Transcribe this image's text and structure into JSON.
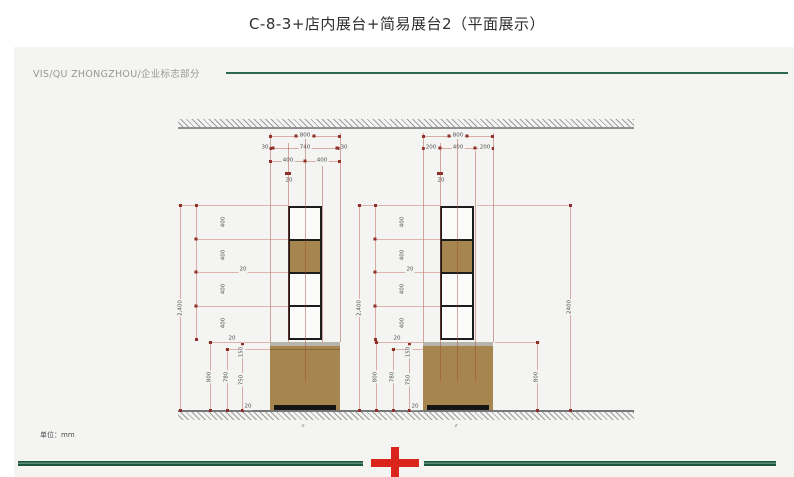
{
  "title": "C-8-3+店内展台+简易展台2（平面展示）",
  "header": {
    "label": "VIS/QU ZHONGZHOU/企业标志部分"
  },
  "footer": {
    "unit_label": "单位：mm"
  },
  "colors": {
    "accent_green": "#2c6a4f",
    "cross_red": "#da251d",
    "wood_brown": "#a6854e",
    "frame_black": "#1c1c1c",
    "dim_tick_red": "#8e2f28",
    "dim_line_pink": "#d9aba5",
    "panel_gray": "#f4f5f3"
  },
  "left_drawing": {
    "marker": "x",
    "top_dims": {
      "total_width": "800",
      "frame_left": "30",
      "inner_width": "740",
      "frame_right": "30",
      "half_left": "400",
      "half_right": "400",
      "board_thickness": "20"
    },
    "side_dims": {
      "overall_height": "2,400",
      "sections": [
        "400",
        "400",
        "400",
        "400"
      ],
      "shelf_thickness_upper": "20",
      "shelf_thickness_lower": "20",
      "counter_height": "800",
      "counter_inner": "780",
      "counter_body": "750",
      "counter_top": "150",
      "plinth": "20"
    }
  },
  "right_drawing": {
    "marker": "z",
    "top_dims": {
      "total_width": "800",
      "side_left": "200",
      "tower_width": "400",
      "side_right": "200",
      "board_thickness": "20"
    },
    "side_dims": {
      "overall_height": "2,400",
      "sections": [
        "400",
        "400",
        "400",
        "400"
      ],
      "shelf_thickness_upper": "20",
      "shelf_thickness_lower": "20",
      "counter_height": "800",
      "counter_inner": "780",
      "counter_body": "750",
      "counter_top": "150",
      "plinth": "20"
    },
    "outer_dims": {
      "counter_height": "800",
      "overall_height": "2400"
    }
  }
}
